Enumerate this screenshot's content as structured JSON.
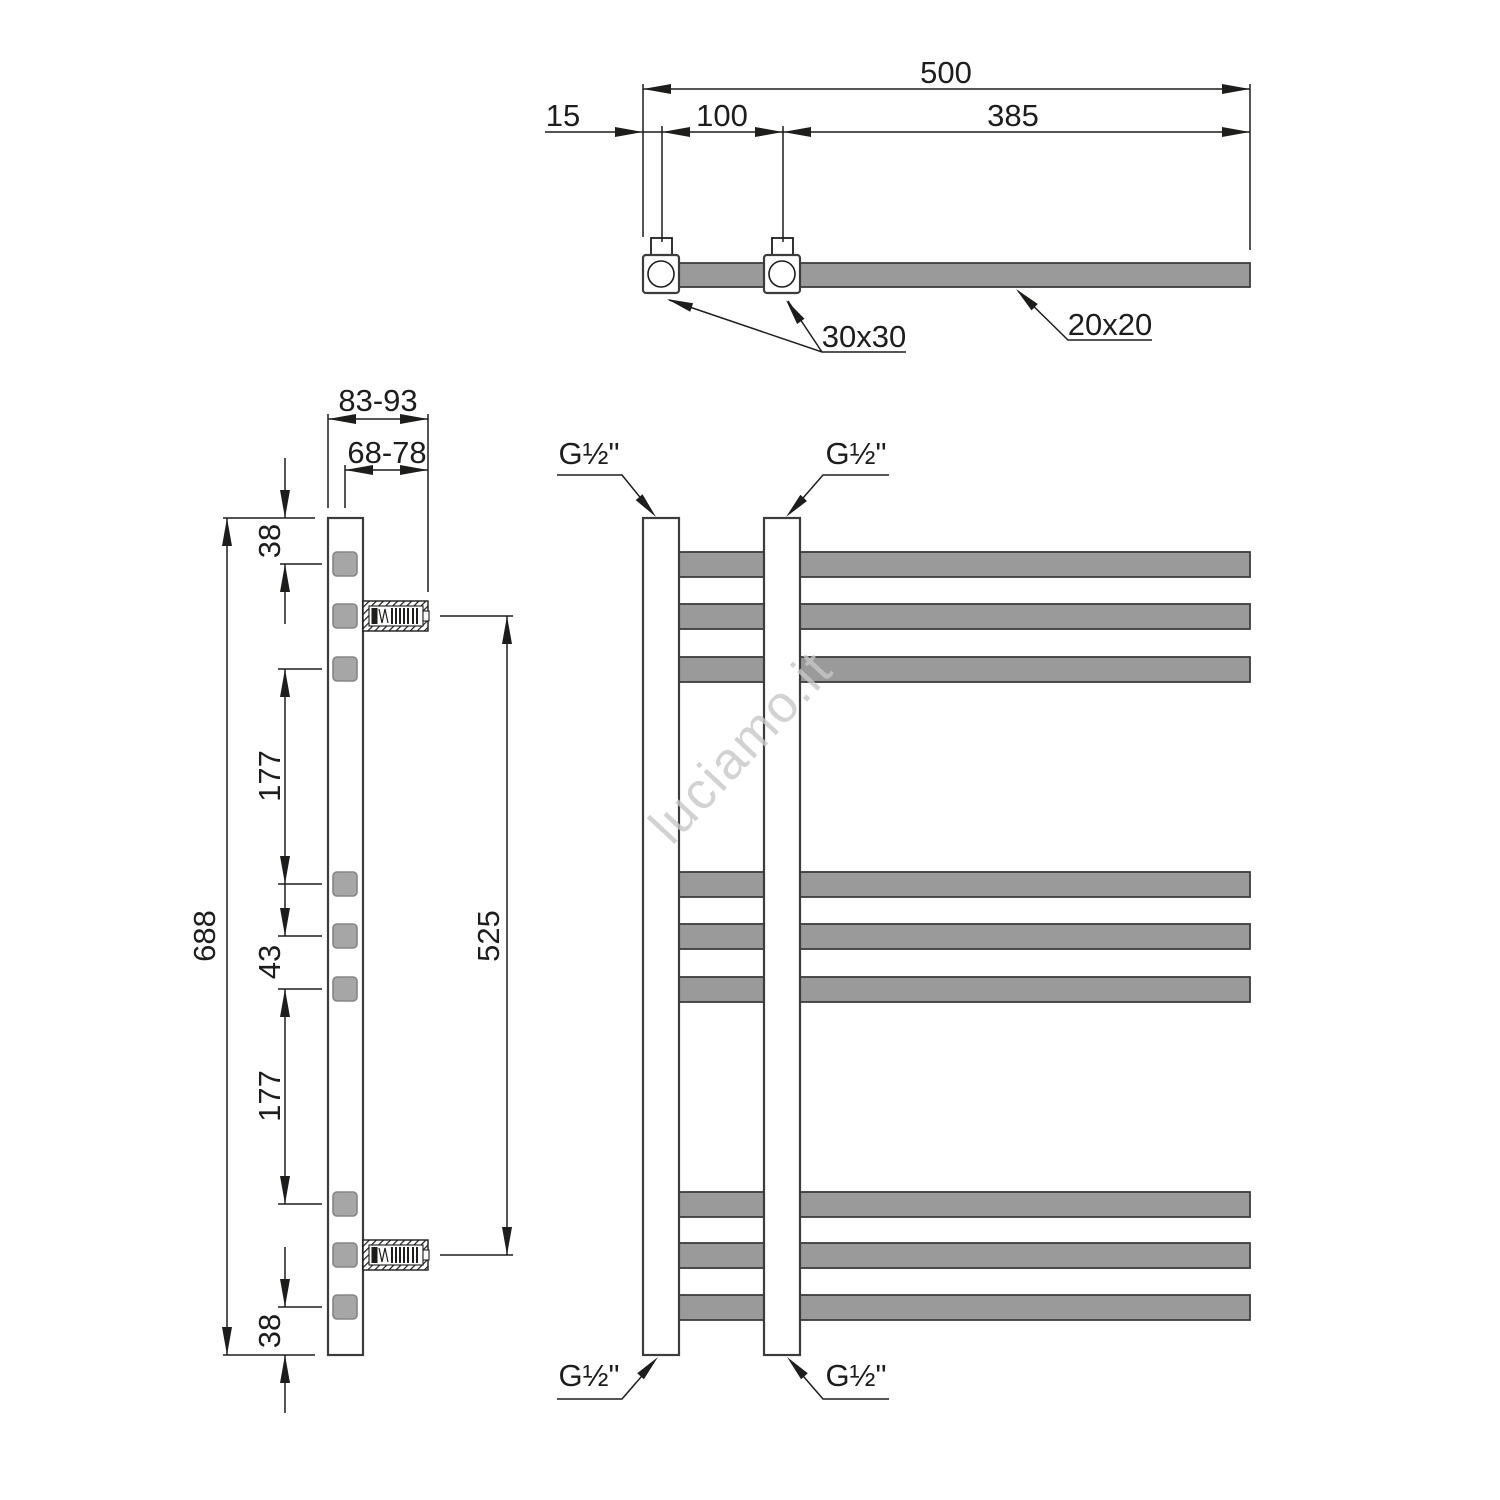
{
  "drawing": {
    "type": "towel-radiator technical dimension drawing",
    "views": [
      "top",
      "side",
      "front"
    ]
  },
  "colors": {
    "background": "#ffffff",
    "line": "#1d1d1b",
    "profile_stroke": "#3c3c3c",
    "gray_fill": "#9a9a9a",
    "side_square_fill": "#a6a6a6",
    "side_square_stroke": "#858585",
    "watermark": "#c7c7c7"
  },
  "watermark": {
    "text": "luciamo.it"
  },
  "top_view": {
    "dim_total_width": "500",
    "dim_end_offset": "15",
    "dim_connection_spacing": "100",
    "dim_remaining": "385",
    "label_fitting_profile": "30x30",
    "label_tube_profile": "20x20"
  },
  "side_view": {
    "dim_depth_range_total": "83-93",
    "dim_depth_range_hook": "68-78",
    "dim_top_offset": "38",
    "dim_gap_upper": "177",
    "dim_rung_pitch": "43",
    "dim_gap_lower": "177",
    "dim_bottom_offset": "38",
    "dim_total_height": "688",
    "dim_bracket_distance": "525"
  },
  "front_view": {
    "connection_top_left": "G½\"",
    "connection_top_right": "G½\"",
    "connection_bottom_left": "G½\"",
    "connection_bottom_right": "G½\""
  }
}
